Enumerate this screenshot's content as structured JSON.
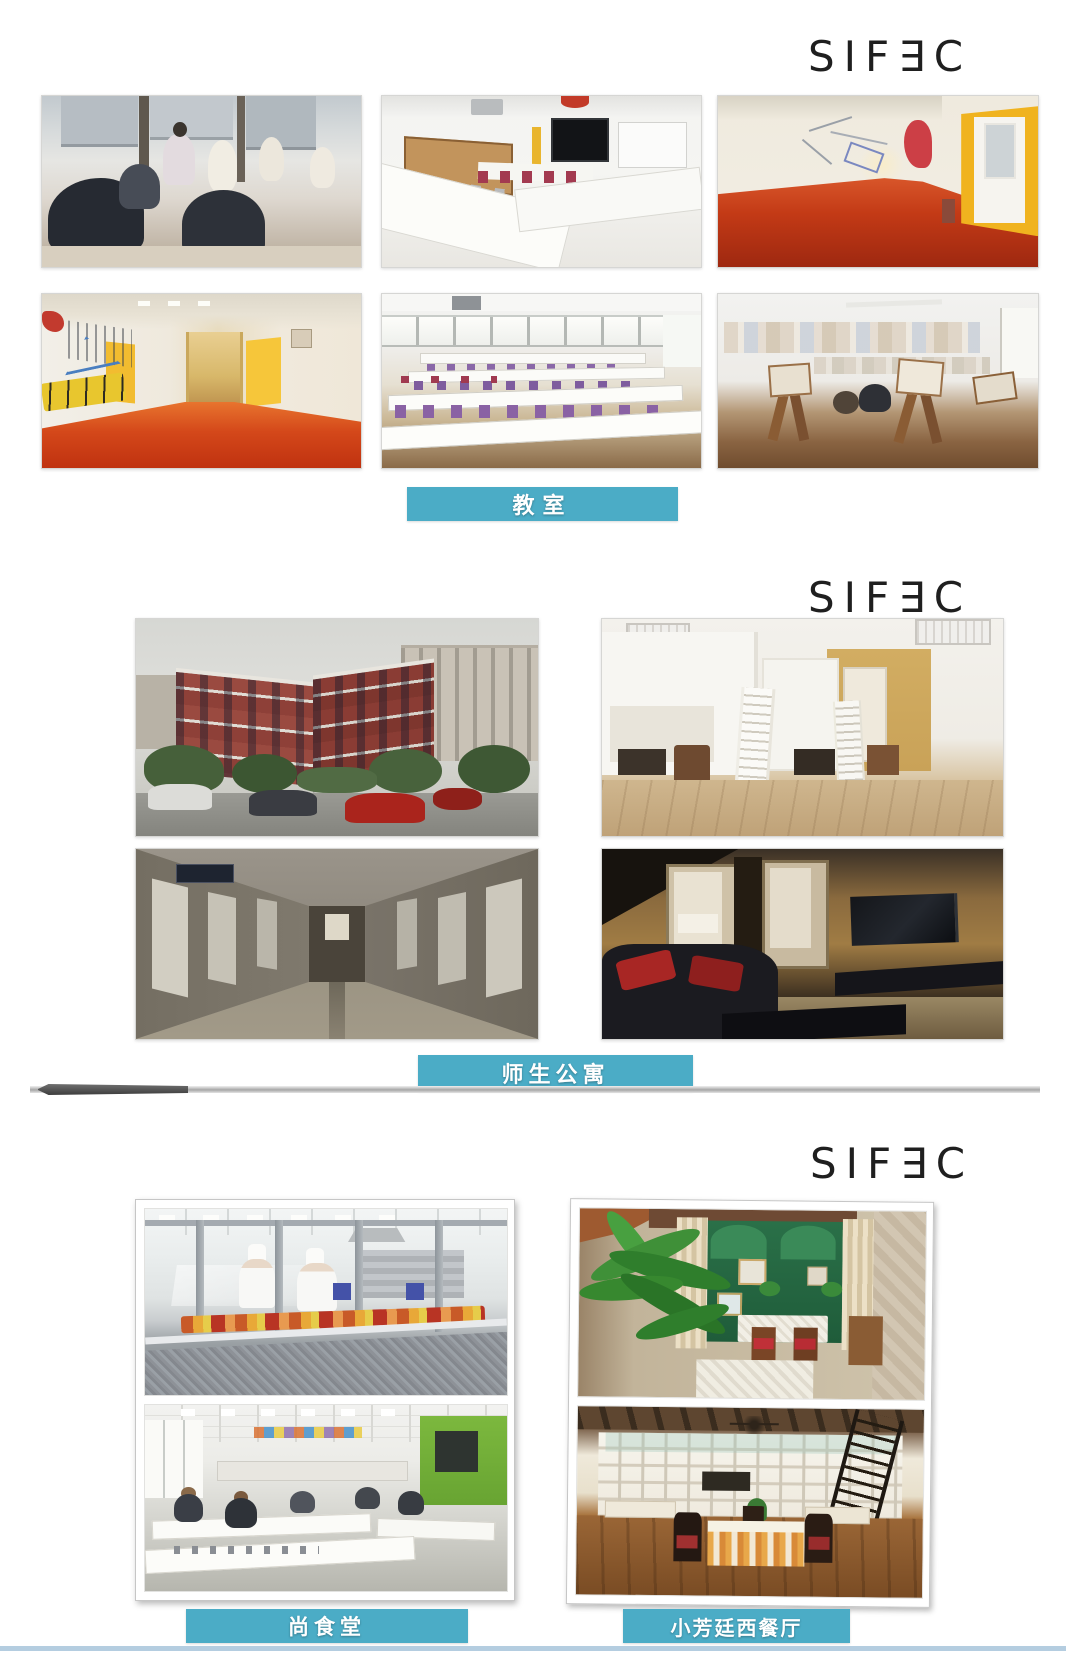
{
  "page": {
    "type": "campus-facilities-brochure",
    "background": "#ffffff"
  },
  "brand": {
    "logo_text": "SIF∃C",
    "logo_color": "#1f1f1f"
  },
  "theme": {
    "banner_color": "#4bacc6",
    "banner_text_color": "#ffffff",
    "divider_color": "#a6a6a6",
    "bottom_rule_color": "#b4cde0"
  },
  "sections": [
    {
      "id": "classrooms",
      "label": "教室",
      "photos": [
        "fashion-design-studio-with-mannequins",
        "classroom-with-tv-and-u-shaped-tables",
        "red-floor-corridor-with-yellow-door",
        "graffiti-corridor-with-yellow-doors",
        "sewing-classroom-rows-of-tables",
        "art-studio-with-easels"
      ]
    },
    {
      "id": "apartments",
      "label": "师生公寓",
      "photos": [
        "red-brick-apartment-building-exterior",
        "dorm-room-with-white-loft-beds",
        "apartment-corridor",
        "apartment-living-room-with-tv"
      ]
    },
    {
      "id": "dining",
      "banners": [
        "尚食堂",
        "小芳廷西餐厅"
      ],
      "photos": [
        "canteen-serving-counter-with-chefs",
        "student-dining-hall",
        "western-restaurant-courtyard",
        "western-restaurant-interior"
      ]
    }
  ]
}
